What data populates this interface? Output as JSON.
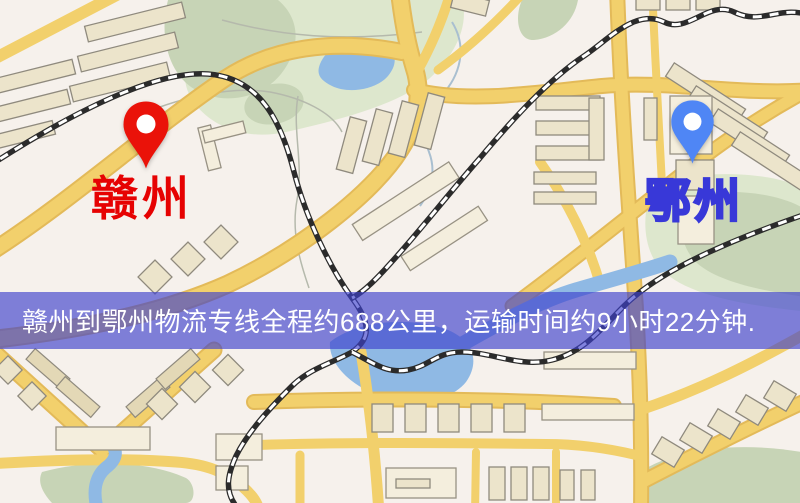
{
  "map": {
    "origin": {
      "label": "赣州"
    },
    "destination": {
      "label": "鄂州"
    }
  },
  "banner": {
    "text": "赣州到鄂州物流专线全程约688公里，运输时间约9小时22分钟."
  },
  "icons": {
    "origin_pin": "red-location-pin",
    "destination_pin": "blue-location-pin"
  },
  "palette": {
    "background": "#f6f1ec",
    "road": "#f2d06c",
    "road_casing": "#e3ba59",
    "water": "#8fb9e4",
    "park_dark": "#c7d4b6",
    "park_pale": "#dde7cd",
    "building_fill": "#ece4cb",
    "building_stroke": "#8f8a7e",
    "railway": "#2b2b2b",
    "banner_bg": "rgba(62,64,205,0.65)",
    "banner_text": "#ffffff",
    "origin_pin": "#ea1209",
    "destination_pin": "#4f86f5",
    "origin_label_color": "#e60202",
    "destination_label_color": "#ffffff",
    "destination_label_stroke": "#3838d8"
  }
}
